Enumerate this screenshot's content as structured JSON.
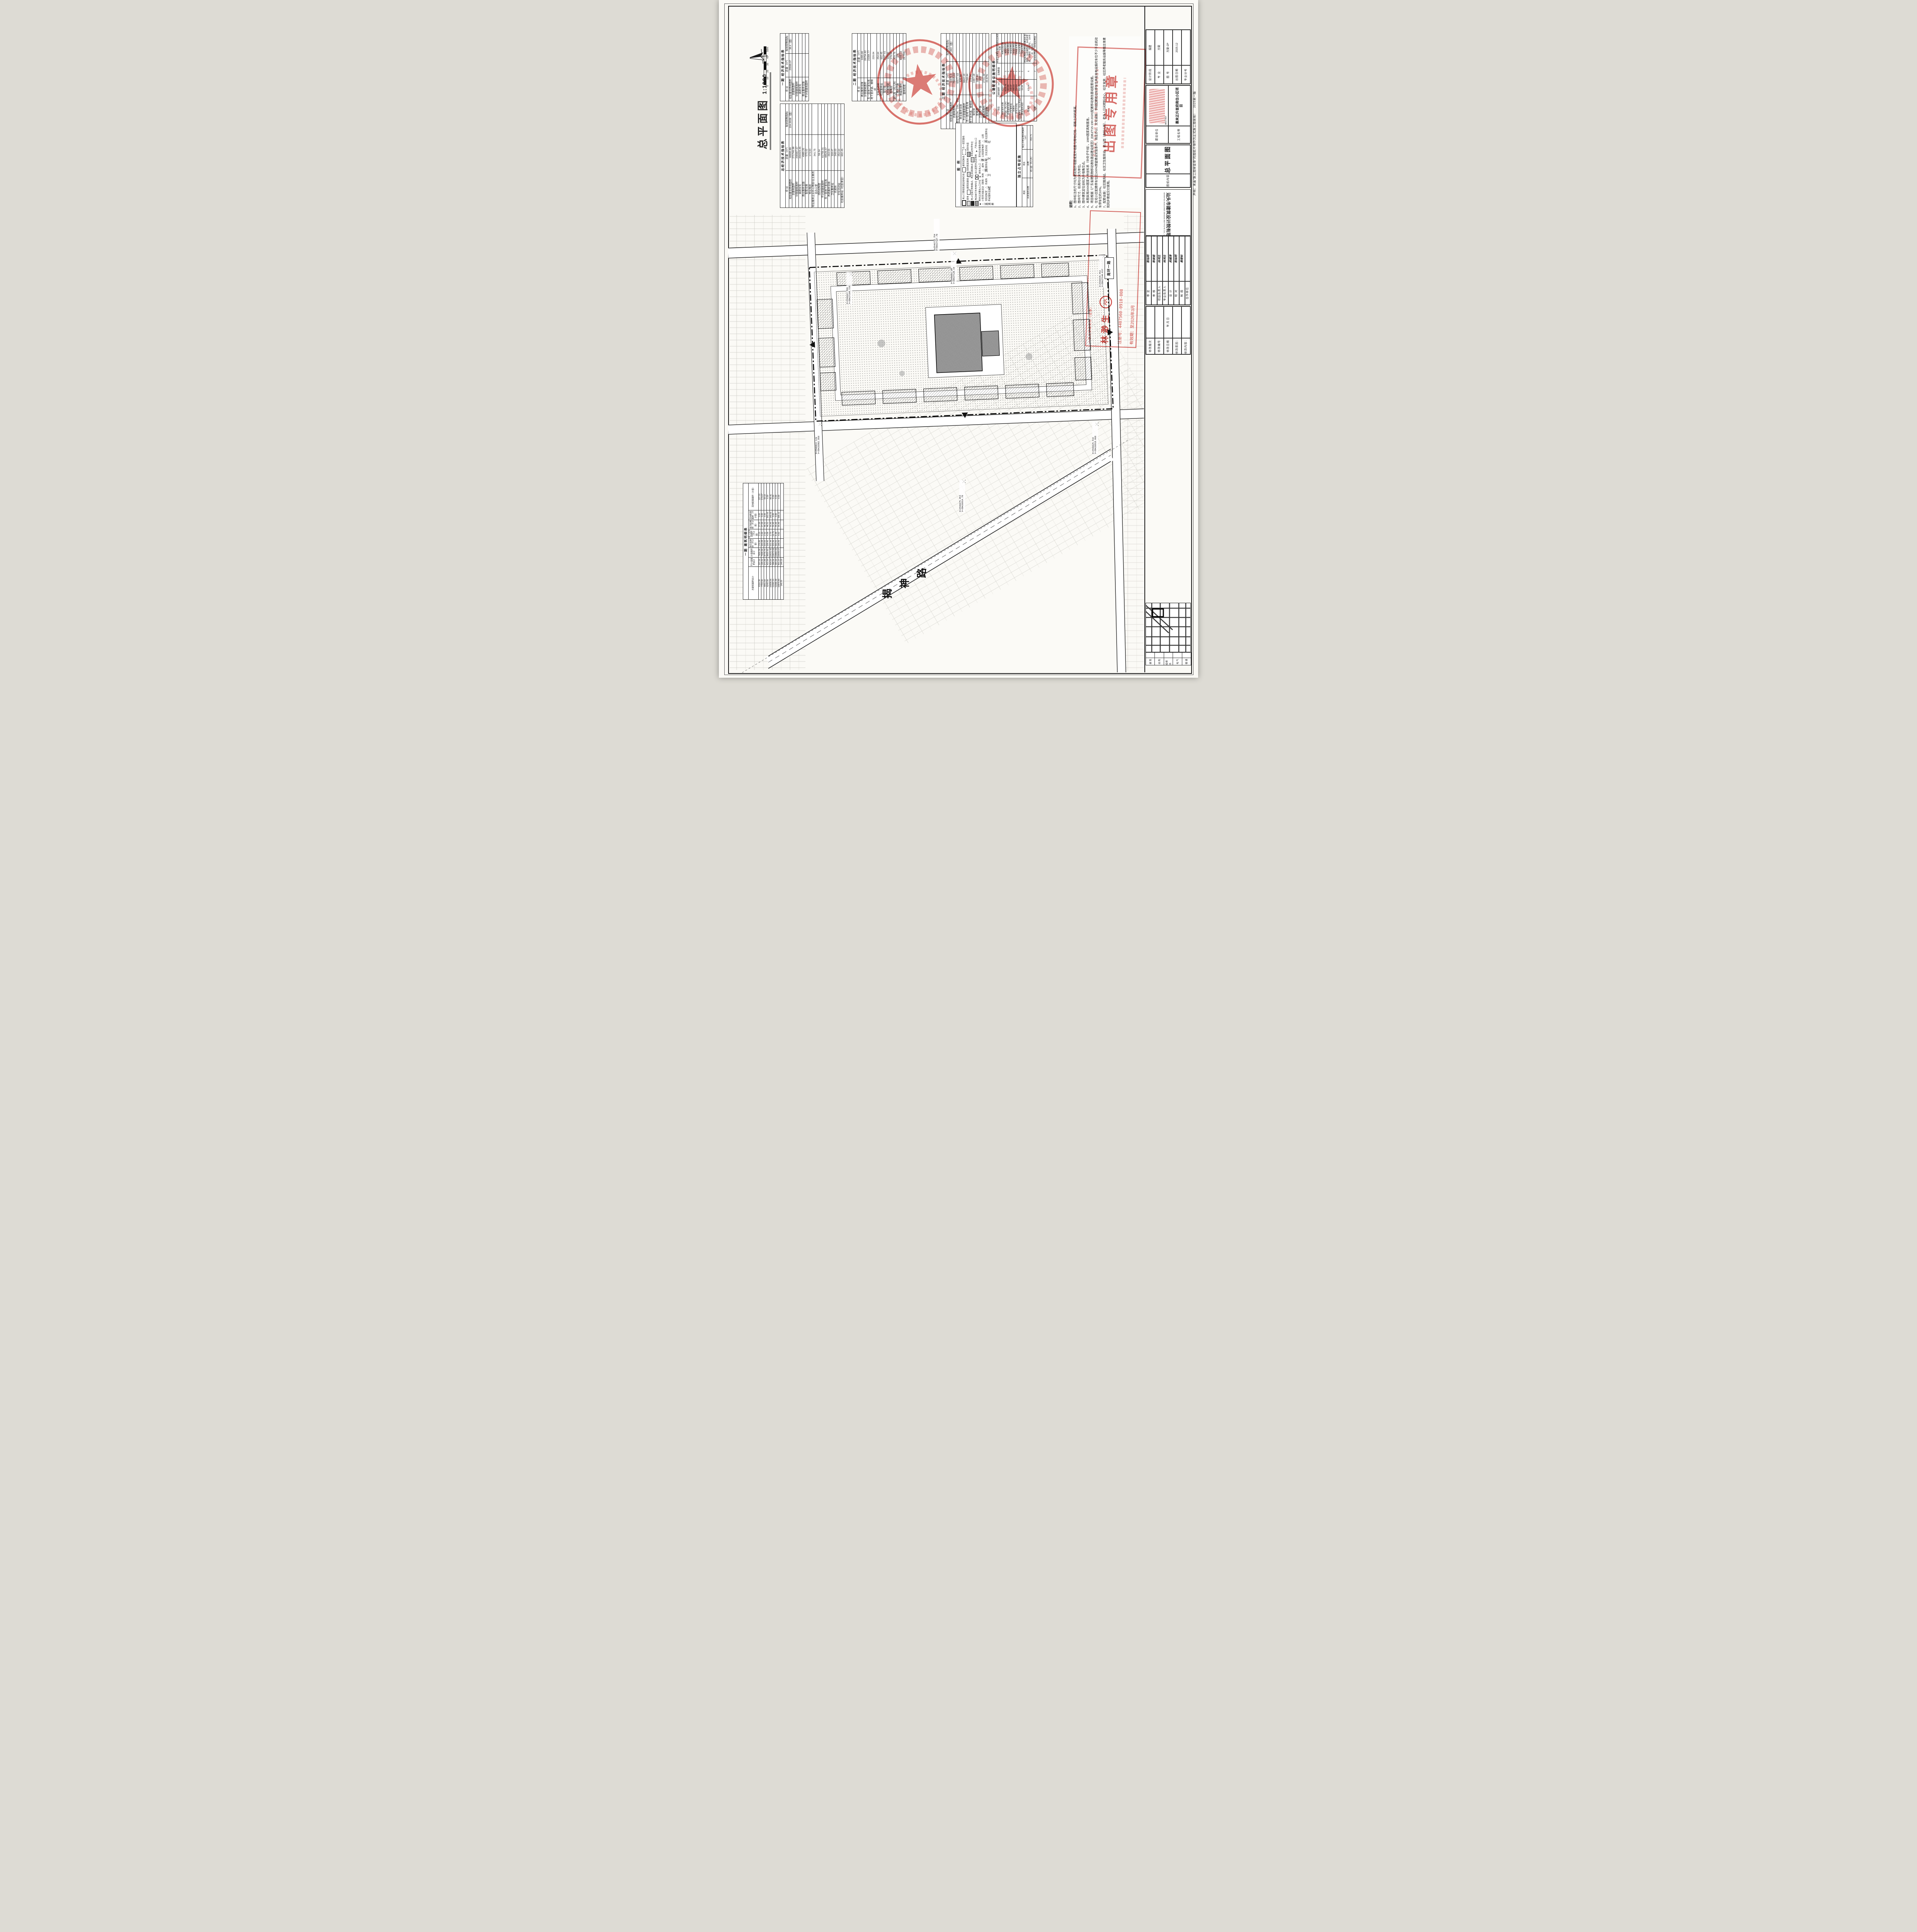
{
  "sheet": {
    "drawing_title": "总平面图",
    "drawing_scale": "1:1000",
    "margin_disclaimer": "声明：未盖“施工图审查章”的图纸不得作为正式施工图使用！",
    "margin_edition": "2025第一版",
    "accent_red": "#cf4742",
    "ink": "#1c1c1c",
    "paper": "#fbfaf6"
  },
  "scalebar": {
    "ticks": [
      "0",
      "10",
      "20",
      "30",
      "40",
      "50m"
    ]
  },
  "tables": {
    "t1": {
      "caption": "一期 经济技术指标表",
      "header": [
        "项  目",
        "总量（m²）",
        "规划控制指标"
      ],
      "rows": [
        [
          "规划建设用地面积",
          "25599.97",
          "38.4（亩）"
        ],
        [
          "总建筑面积",
          "",
          ""
        ],
        [
          "计容建筑面积",
          "",
          ""
        ],
        [
          "高层住宅",
          "",
          ""
        ],
        [
          "商业服务设施",
          "",
          ""
        ],
        [
          "不计容建筑面积",
          "",
          ""
        ]
      ]
    },
    "t2": {
      "caption": "总经济技术指标表",
      "header": [
        "项  目",
        "总量（m²）",
        "规划控制指标"
      ],
      "rows": [
        [
          "规划建设用地面积",
          "69995.89",
          "104.9938（亩）"
        ],
        [
          "总建筑面积",
          "271746.98",
          ""
        ],
        [
          "计容建筑面积",
          "209987.67",
          ""
        ],
        [
          "高层住宅",
          "204423.45",
          ""
        ],
        [
          "商业服务设施",
          "4989.20",
          ""
        ],
        [
          "配套设施",
          "575.02",
          ""
        ],
        [
          "物业电房",
          "173.93",
          ""
        ],
        [
          "物业服务企业办公用房/业主委员会办公室",
          "341.75",
          ""
        ],
        [
          "消防控制室",
          "59.34",
          ""
        ],
        [
          "不计容建筑面积",
          "61759.31",
          ""
        ],
        [
          "负一层地下室车库",
          "48526.97",
          ""
        ],
        [
          "养老服务设施",
          "263.55",
          ""
        ],
        [
          "卫生服务站",
          "118.47",
          ""
        ],
        [
          "托老所",
          "348.03",
          ""
        ],
        [
          "文化活动站",
          "254.64",
          ""
        ],
        [
          "社区服务站（社区食堂）",
          "602.45",
          ""
        ]
      ]
    },
    "t3": {
      "caption": "二期 经济技术指标表",
      "header": [
        "项  目",
        "总量（m²）"
      ],
      "rows": [
        [
          "商业服务设施",
          "1055.80"
        ],
        [
          "计容建筑面积",
          "28754.82"
        ],
        [
          "负一层地下室车库",
          "23384.77"
        ],
        [
          "地下室井道、楼梯间",
          "220.04"
        ],
        [
          "文化活动站",
          "254.64"
        ],
        [
          "社区服务站",
          "602.45"
        ],
        [
          "架空层",
          "1647.61"
        ],
        [
          "人防报警间",
          "110.85"
        ],
        [
          "配电房",
          "176.54"
        ],
        [
          "幼儿园（托儿所）",
          "429.76"
        ],
        [
          "二期总户数",
          "376"
        ],
        [
          "楼基底面积",
          "8348.13"
        ],
        [
          "建筑密度",
          "25.75%"
        ]
      ]
    },
    "t4": {
      "caption": "三期 经济技术指标表",
      "header": [
        "项  目",
        "总量（m²）",
        "规划控制指标"
      ],
      "rows": [
        [
          "规划建设用地面积",
          "11975.3",
          "17.963（亩）"
        ],
        [
          "总建筑面积",
          "75845.61",
          ""
        ],
        [
          "高层住宅13#、14#、15#",
          "65577.63",
          ""
        ],
        [
          "商业服务设施",
          "525.88",
          ""
        ],
        [
          "不计容建筑面积",
          "9842.10",
          ""
        ],
        [
          "负一层地下室车库",
          "7769.44",
          ""
        ],
        [
          "地下室井道、楼梯间",
          "223.04",
          ""
        ],
        [
          "架空层",
          "1687.18",
          ""
        ],
        [
          "配电房",
          "162.44",
          ""
        ],
        [
          "三期总户数",
          "432",
          ""
        ],
        [
          "楼基底面积",
          "2741.38",
          ""
        ],
        [
          "建筑密度",
          "22.87%",
          ""
        ]
      ]
    },
    "t5": {
      "caption": "公建配套设施明细表",
      "header": [
        "项目",
        "建筑面积（m²）",
        "设施数量",
        "非独立占地设施所在建筑及具体位置"
      ],
      "rows": [
        [
          "商业服务设施",
          "4989.2",
          "",
          "用地沿路四周"
        ],
        [
          "幼儿园（托儿所）",
          "4229.76",
          "1",
          "地块西北侧"
        ],
        [
          "养老服务设施",
          "263.85",
          "1",
          "4#商业首层"
        ],
        [
          "卫生服务站",
          "118.47",
          "1",
          "8#商业首层"
        ],
        [
          "托老所",
          "348.03",
          "1",
          "8#商业首层"
        ],
        [
          "文化活动站",
          "254.64",
          "1",
          "10#商业首层"
        ],
        [
          "社区服务站（社区食堂）",
          "602.45",
          "1",
          "12#商业首层"
        ],
        [
          "物业服务用房",
          "64.64",
          "1",
          "5#商业首层"
        ],
        [
          "配电房",
          "675.96",
          "6",
          "物业配电房:3#首层商铺北侧 配电房：5#商铺西侧、8#商业首层、9#西侧（庭院内）、10#东侧（庭院内）"
        ],
        [
          "公厕",
          "",
          "2",
          "8#商业首层、16#商业首层"
        ]
      ]
    },
    "t6": {
      "caption": "一期 建筑明细表",
      "header": [
        "总建筑面积合计",
        "不计容面积合计",
        "计容面积合计",
        "架空层面积（不计容）",
        "地下室井道面积（不计容）",
        "屋顶层面积（不计容）",
        "其他配套面积（不计容）",
        "其他配套面积（计容）"
      ],
      "rows": [
        [
          "8116.38",
          "207.00",
          "7909.38",
          "176.85",
          "3.15",
          "27.00",
          "0.00",
          "227.02"
        ],
        [
          "7703.56",
          "195.52",
          "7508.04",
          "165.08",
          "3.44",
          "27.00",
          "0.00",
          "174.07"
        ],
        [
          "9051.60",
          "271.85",
          "8779.75",
          "223.02",
          "2.52",
          "46.31",
          "0.00",
          "93.52"
        ],
        [
          "9243.56",
          "422.64",
          "8820.92",
          "108.42",
          "4.36",
          "46.31",
          "263.55",
          "0.00"
        ],
        [
          "10936.06",
          "404.64",
          "10531.42",
          "221.44",
          "2.70",
          "35.45",
          "145.05",
          "80.41"
        ],
        [
          "11262.15",
          "388.56",
          "10873.59",
          "333.36",
          "19.75",
          "35.45",
          "0.00",
          "0.00"
        ],
        [
          "11266.49",
          "383.94",
          "10882.55",
          "342.01",
          "6.48",
          "35.45",
          "0.00",
          "0.00"
        ],
        [
          "10870.80",
          "831.23",
          "10039.57",
          "196.05",
          "4.62",
          "35.45",
          "595.11",
          "0.00"
        ],
        [
          "149.25",
          "149.25",
          "",
          "",
          "",
          "",
          "",
          ""
        ]
      ]
    },
    "t7": {
      "caption": "独立占地设施",
      "header": [
        "类别",
        "项目",
        "独立占地设施用地面积（m²）"
      ],
      "rows": [
        [
          "商业服务设施",
          "商铺",
          ""
        ],
        [
          "",
          "幼儿园（托儿所）",
          "652.71"
        ]
      ]
    }
  },
  "legend": {
    "title": "图  例",
    "items": [
      {
        "sym": "rect-bold",
        "label": "地上三期规划建设用地红线"
      },
      {
        "sym": "rect",
        "label": "建筑控制线"
      },
      {
        "sym": "rect-dash",
        "label": "负一层范围线"
      },
      {
        "sym": "dots",
        "label": "绿地"
      },
      {
        "sym": "rect-thin",
        "label": "建筑轮廓线"
      },
      {
        "sym": "hatch",
        "label": "消防登高场地"
      },
      {
        "sym": "lane",
        "label": "消防车道"
      },
      {
        "sym": "solid",
        "label": "地上垃圾分类收集点、再生资源回收点"
      },
      {
        "sym": "hatch2",
        "label": "非机动车停车位"
      },
      {
        "sym": "hatch3",
        "label": "电动自行车充电车位"
      },
      {
        "sym": "xbox",
        "label": "幼儿园室外活动场地"
      },
      {
        "sym": "arrow",
        "label": "汽车出入口"
      },
      {
        "sym": "arrow-solid",
        "label": "地块主次要出入口方位"
      },
      {
        "sym": "arrow-sm",
        "label": "单体出入口"
      },
      {
        "sym": "tri:健",
        "label": "室外综合健身用地"
      },
      {
        "sym": "tri:运",
        "label": "小型多功能运动（球类）场地"
      },
      {
        "sym": "tri:超",
        "label": "超市"
      },
      {
        "sym": "tri:电",
        "label": "公用变配电房"
      },
      {
        "sym": "tri:厕",
        "label": "公厕"
      },
      {
        "sym": "tri:消",
        "label": "消防控制室"
      },
      {
        "sym": "tri:老",
        "label": "托老所"
      },
      {
        "sym": "tri:卫",
        "label": "卫生服务站"
      },
      {
        "sym": "tri:文",
        "label": "文化活动站"
      },
      {
        "sym": "tri:社",
        "label": "社区服务站"
      },
      {
        "sym": "tri:养",
        "label": "养老服务设施"
      }
    ]
  },
  "notes": {
    "title": "说明：",
    "items": [
      "1、图中标注的尺寸均为建筑物外墙面或室外墙面与用地红线、道路之间的距离。",
      "2、图中尺寸、标高均以米为单位。",
      "3、图中建筑定位坐标为外墙角交点。",
      "4、本图采用2000国家大地坐标系（中央子午线），1985国家高程基准。",
      "5、项目根据《广东省建筑物移动通信基站建设规范》(DBJ/T15-190-2020)配置移动通信基站配套设施。",
      "6、住宅小区配建停车位应100%预留建设安装条件，商业办公、文化设施、学校配建机动车停车位具有充电设施的车位不少于总机动车停车位的10%。",
      "7、配套设施：社区服务站、社区卫生服务站、幼儿园（含托儿所）、老年人日间照料中心、社区食堂、社区养老服务设施等随主体建筑同步建成交付使用。"
    ]
  },
  "stamps": {
    "out_stamp_text": "出图专用章",
    "architect_box": {
      "title": "一级注册建筑师（签章）",
      "name": "林渺生",
      "reg_no": "注册号：4407560-0910-008",
      "valid": "有效期：至2026年3月"
    }
  },
  "title_block": {
    "company_cn": "汕头市建筑设计院有限公司",
    "company_en": "SHANTOU BUILDING DESIGN INSTITUTE CO., LTD.",
    "fields": [
      [
        "设计阶段",
        "报建"
      ],
      [
        "专  业",
        "方案"
      ],
      [
        "图  号",
        "方案-ZP"
      ],
      [
        "出图日期",
        "2025.12"
      ],
      [
        "专业分号",
        ""
      ]
    ],
    "project": [
      [
        "建设单位",
        ""
      ],
      [
        "工程名称",
        "惠来正升首府商住小区项目"
      ]
    ],
    "archive_no": "A017367",
    "content_label": "图纸内容",
    "content_value": "总平面图",
    "people": [
      [
        "审  定",
        "陈灿明"
      ],
      [
        "审  核",
        "陈彼庭"
      ],
      [
        "项目负责人",
        "林鸿生"
      ],
      [
        "专业负责人",
        "林鸿生"
      ],
      [
        "设  计",
        "吴越涛"
      ],
      [
        "校  对",
        "陈灿明"
      ],
      [
        "制  图",
        "黄楚标"
      ],
      [
        "合作单位",
        ""
      ]
    ],
    "revision": [
      [
        "修改版次",
        ""
      ],
      [
        "修改编号",
        ""
      ],
      [
        "修改日期",
        "年  月  日"
      ],
      [
        "修改原因：",
        ""
      ],
      [
        "修改内容：",
        ""
      ]
    ],
    "signoff_cells": [
      "建  筑",
      "结  构",
      "给排水",
      "电  气",
      "暖  通"
    ]
  },
  "plan": {
    "road_labels": [
      "揭神路",
      "南环一路"
    ],
    "coords": [
      {
        "x": "X=2546712.754",
        "y": "Y=39427127.79"
      },
      {
        "x": "X=2546661.29",
        "y": "Y=39427128.19"
      },
      {
        "x": "X=2546535.552",
        "y": "Y=39427144.017"
      },
      {
        "x": "X=2546647.586",
        "y": "Y=39427104.729"
      },
      {
        "x": "X=2546822.129",
        "y": "Y=39426902.858"
      },
      {
        "x": "X=2546625.532",
        "y": "Y=39426918.068"
      },
      {
        "x": "X=2546675.053",
        "y": "Y=39426914.70"
      }
    ]
  }
}
